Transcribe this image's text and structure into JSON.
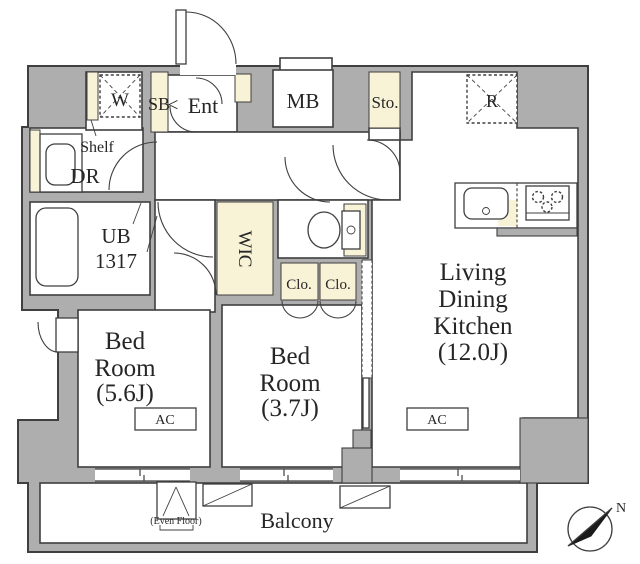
{
  "colors": {
    "wall_gray": "#aeaeae",
    "fixture_cream": "#f8f3d7",
    "line_dark": "#3f3f3f",
    "floor_white": "#ffffff"
  },
  "labels": {
    "washer": "W",
    "shoe_box": "SB",
    "entrance_arrow": "<",
    "entrance": "Ent",
    "meter_box": "MB",
    "storage": "Sto.",
    "refrigerator": "R",
    "shelf": "Shelf",
    "dressing_room": "DR",
    "unit_bath_line1": "UB",
    "unit_bath_line2": "1317",
    "walk_in_closet": "WIC",
    "closet_left": "Clo.",
    "closet_right": "Clo.",
    "ldk_line1": "Living",
    "ldk_line2": "Dining",
    "ldk_line3": "Kitchen",
    "ldk_size": "(12.0J)",
    "bedroom1_line1": "Bed",
    "bedroom1_line2": "Room",
    "bedroom1_size": "(5.6J)",
    "bedroom2_line1": "Bed",
    "bedroom2_line2": "Room",
    "bedroom2_size": "(3.7J)",
    "ac_bedroom1": "AC",
    "ac_ldk": "AC",
    "balcony": "Balcony",
    "even_floor_note": "(Even Floor)",
    "compass_north": "N"
  }
}
